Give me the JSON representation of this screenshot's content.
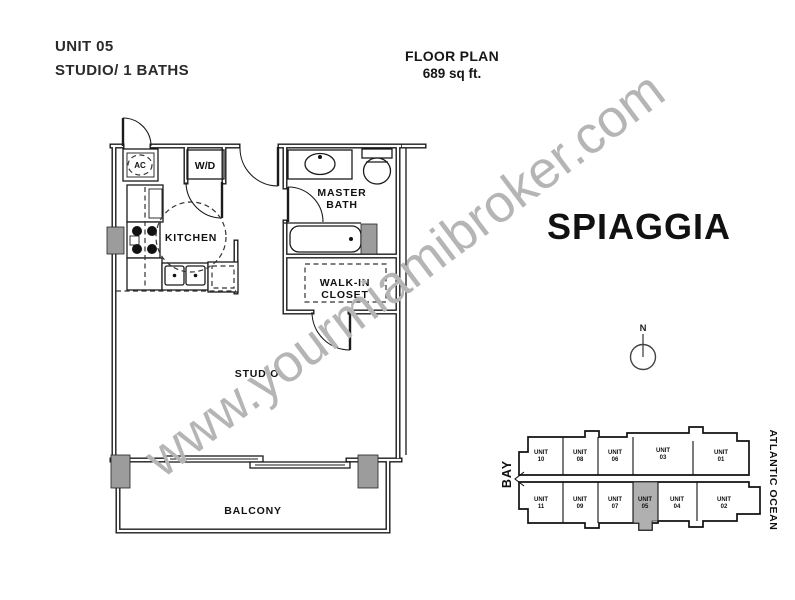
{
  "header": {
    "unit_label": "UNIT 05",
    "unit_type": "STUDIO/ 1 BATHS"
  },
  "plan_header": {
    "title": "FLOOR PLAN",
    "area": "689 sq ft."
  },
  "building_name": "SPIAGGIA",
  "watermark_text": "www.yourmiamibroker.com",
  "compass_label": "N",
  "floorplan": {
    "labels": {
      "kitchen": "KITCHEN",
      "master_bath_line1": "MASTER",
      "master_bath_line2": "BATH",
      "walkin_line1": "WALK-IN",
      "walkin_line2": "CLOSET",
      "studio": "STUDIO",
      "balcony": "BALCONY",
      "ac_closet": "AC",
      "washer_dryer": "W/D"
    }
  },
  "keyplan": {
    "bay_label": "BAY",
    "ocean_label": "ATLANTIC OCEAN",
    "unit_word": "UNIT",
    "top_row": [
      "10",
      "08",
      "06",
      "03",
      "01"
    ],
    "bottom_row": [
      "11",
      "09",
      "07",
      "05",
      "04",
      "02"
    ],
    "highlighted_unit": "05",
    "highlight_color": "#b0b0b0"
  },
  "colors": {
    "line": "#1b1b1b",
    "column_fill": "#9c9c9c",
    "watermark": "#b5b5b5"
  }
}
